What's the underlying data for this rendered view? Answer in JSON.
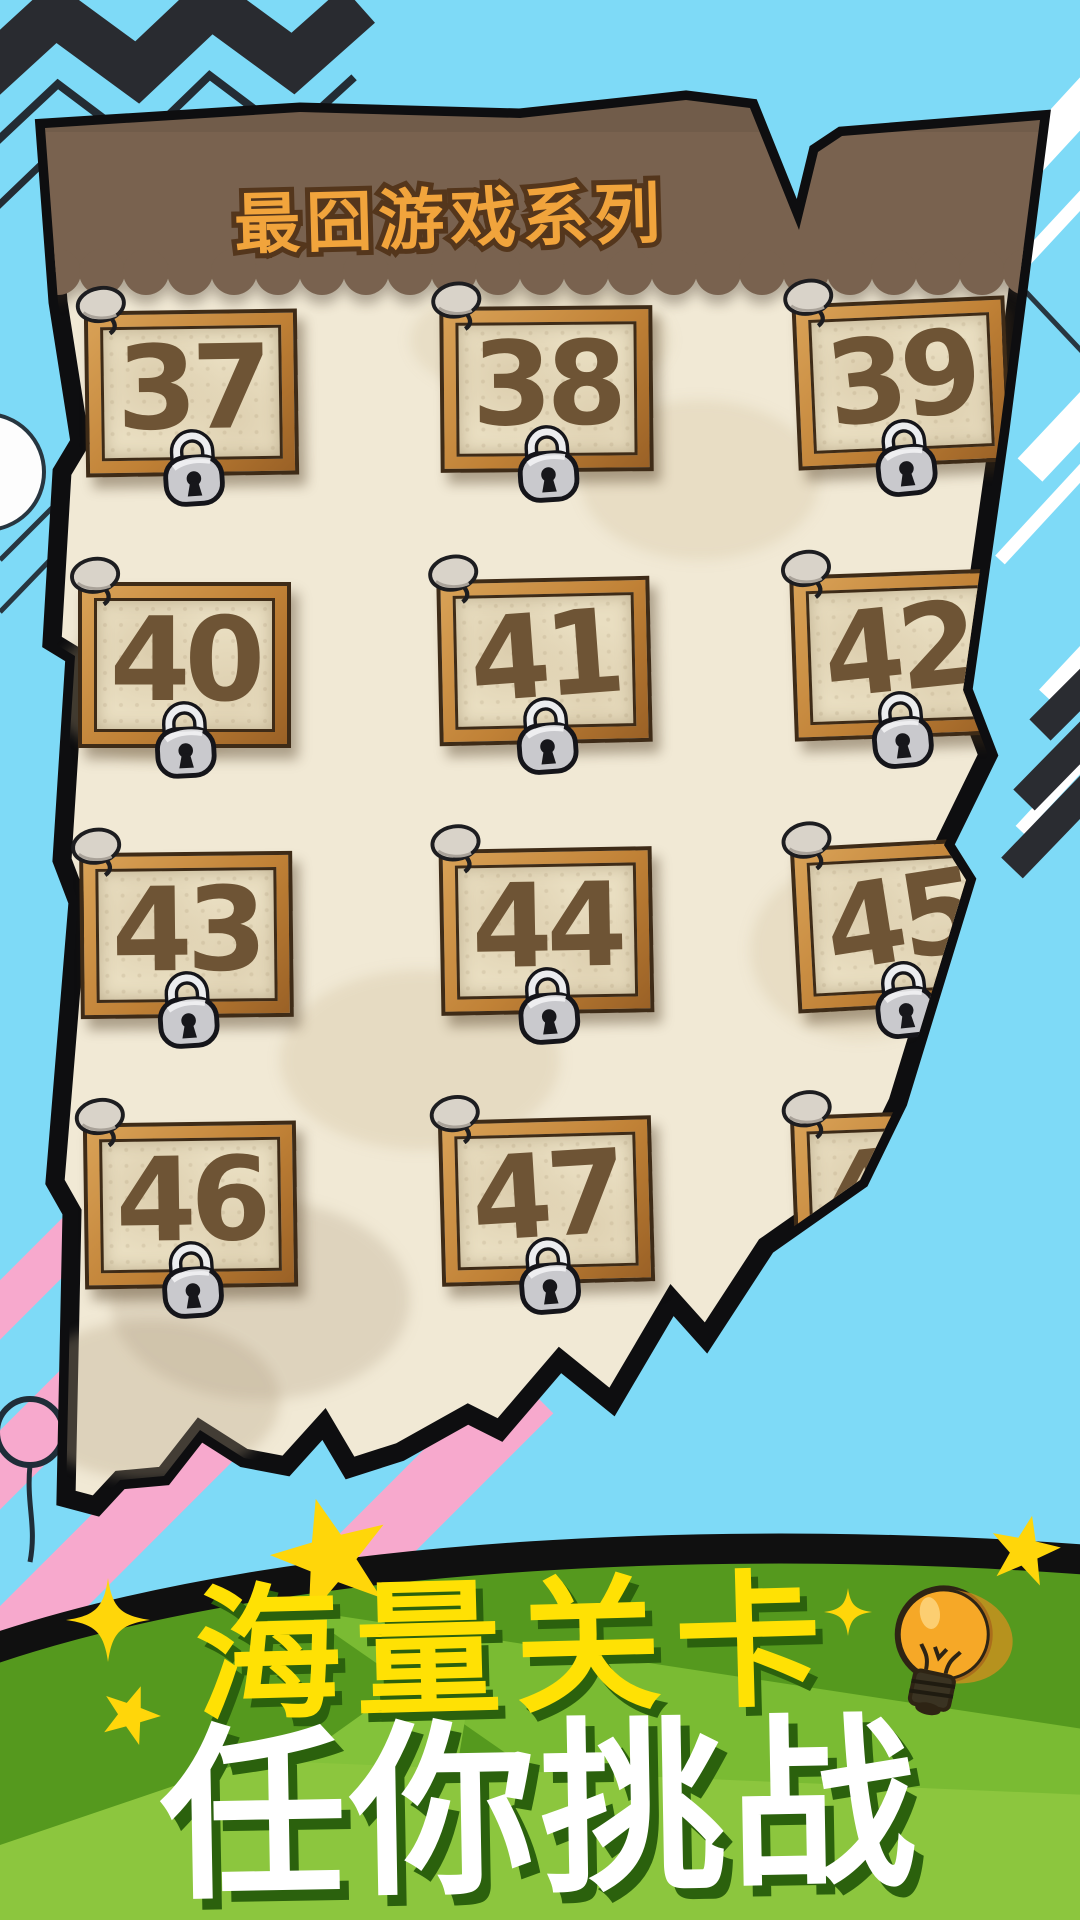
{
  "header": {
    "title": "最囧游戏系列"
  },
  "levels": [
    {
      "number": "37",
      "locked": true
    },
    {
      "number": "38",
      "locked": true
    },
    {
      "number": "39",
      "locked": true
    },
    {
      "number": "40",
      "locked": true
    },
    {
      "number": "41",
      "locked": true
    },
    {
      "number": "42",
      "locked": true
    },
    {
      "number": "43",
      "locked": true
    },
    {
      "number": "44",
      "locked": true
    },
    {
      "number": "45",
      "locked": true
    },
    {
      "number": "46",
      "locked": true
    },
    {
      "number": "47",
      "locked": true
    },
    {
      "number": "48",
      "locked": true
    }
  ],
  "footer": {
    "tagline_line1": "海量关卡",
    "tagline_line2": "任你挑战"
  },
  "icons": {
    "lock": "padlock",
    "pin": "thumbtack",
    "bulb": "light-bulb",
    "star": "star",
    "sparkle": "sparkle"
  },
  "colors": {
    "background_blue": "#7EDAF7",
    "panel_paper": "#F1E9D5",
    "header_band_brown": "#79624F",
    "title_orange": "#F1A43C",
    "card_frame_wood": "#C08136",
    "card_paper": "#E9DEC1",
    "card_number_brown": "#6E5435",
    "lock_gray": "#C9C9CD",
    "banner_green_dark": "#55991E",
    "banner_green_light": "#8CC63E",
    "tagline_yellow": "#FFE104",
    "tagline_white": "#FFFFFF",
    "accent_pink": "#F7A9CD",
    "zigzag_dark": "#292B30"
  }
}
